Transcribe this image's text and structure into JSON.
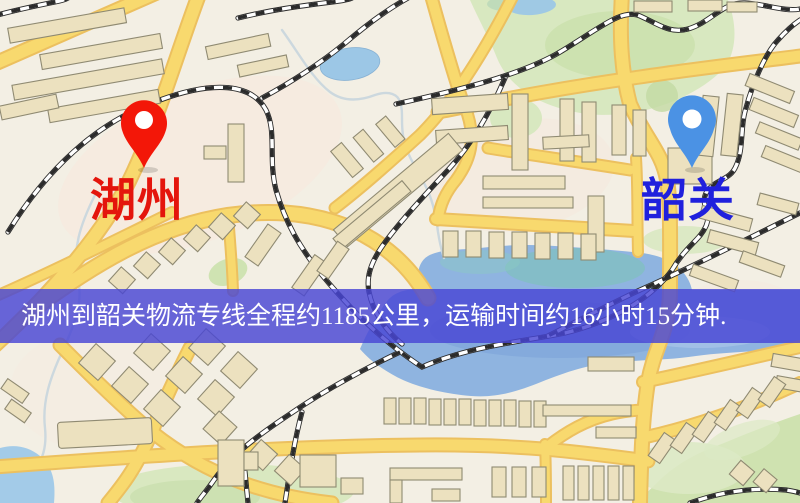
{
  "map": {
    "origin_marker": {
      "label": "湖州",
      "icon": "map-pin",
      "pin_color": "#f31708",
      "label_color": "#e4150c"
    },
    "destination_marker": {
      "label": "韶关",
      "icon": "map-pin",
      "pin_color": "#4b92e4",
      "label_color": "#2020dd"
    },
    "colors": {
      "background": "#f3efe4",
      "road": "#f8d96e",
      "road_casing": "#ecc05f",
      "water": "#8fb4e0",
      "park": "#d8e8c0",
      "railway": "#2b2b2b",
      "building": "#ece1bf",
      "banner": "rgba(72,70,212,0.82)"
    }
  },
  "banner": {
    "text": "湖州到韶关物流专线全程约1185公里，运输时间约16小时15分钟.",
    "text_color": "#ffffff"
  }
}
